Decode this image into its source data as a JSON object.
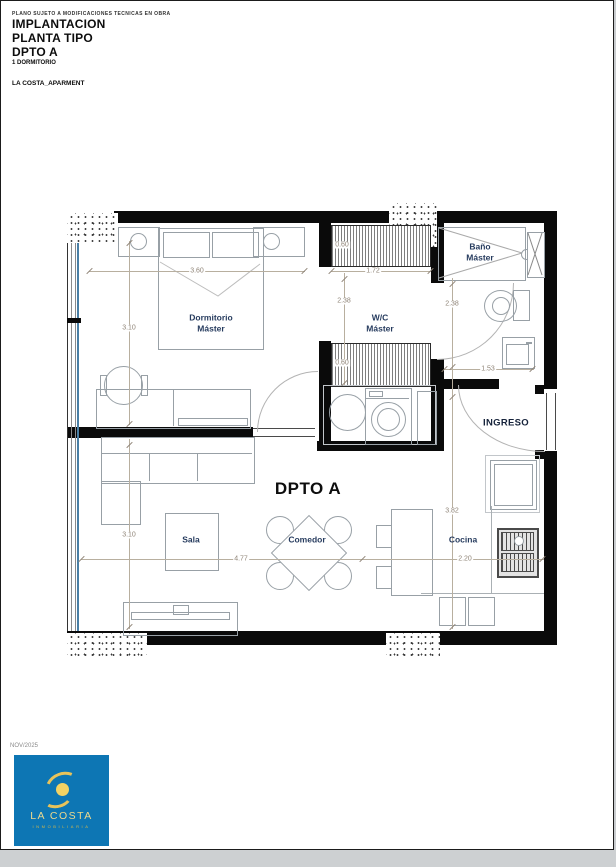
{
  "header": {
    "disclaimer": "PLANO SUJETO A MODIFICACIONES TECNICAS EN OBRA",
    "title_lines": [
      "IMPLANTACION",
      "PLANTA TIPO",
      "DPTO A"
    ],
    "subtitle": "1 DORMITORIO",
    "project": "LA COSTA_APARMENT"
  },
  "plan": {
    "unit_label": "DPTO A",
    "rooms": {
      "dormitorio": {
        "line1": "Dormitorio",
        "line2": "Máster"
      },
      "wc": {
        "line1": "W/C",
        "line2": "Máster"
      },
      "bano": {
        "line1": "Baño",
        "line2": "Máster"
      },
      "sala": {
        "label": "Sala"
      },
      "comedor": {
        "label": "Comedor"
      },
      "cocina": {
        "label": "Cocina"
      },
      "ingreso": {
        "label": "INGRESO"
      }
    },
    "dimensions": {
      "dorm_width": "3.60",
      "dorm_height": "3.10",
      "wc_width": "1.72",
      "wc_height": "2.38",
      "closet_top": "0.60",
      "closet_bottom": "0.60",
      "bano_height": "2.38",
      "bano_width": "1.53",
      "sala_height": "3.10",
      "sala_width": "4.77",
      "cocina_height": "3.82",
      "cocina_width": "2.20"
    }
  },
  "footer": {
    "date": "NOV/2025",
    "logo_title": "LA COSTA",
    "logo_subtitle": "INMOBILIARIA"
  },
  "colors": {
    "wall": "#0a0a0a",
    "room_label": "#263b5e",
    "dim_label": "#8f8477",
    "glazing": "#4a7fa5",
    "logo_bg": "#0d76b4",
    "logo_gold": "#e8c35a"
  }
}
